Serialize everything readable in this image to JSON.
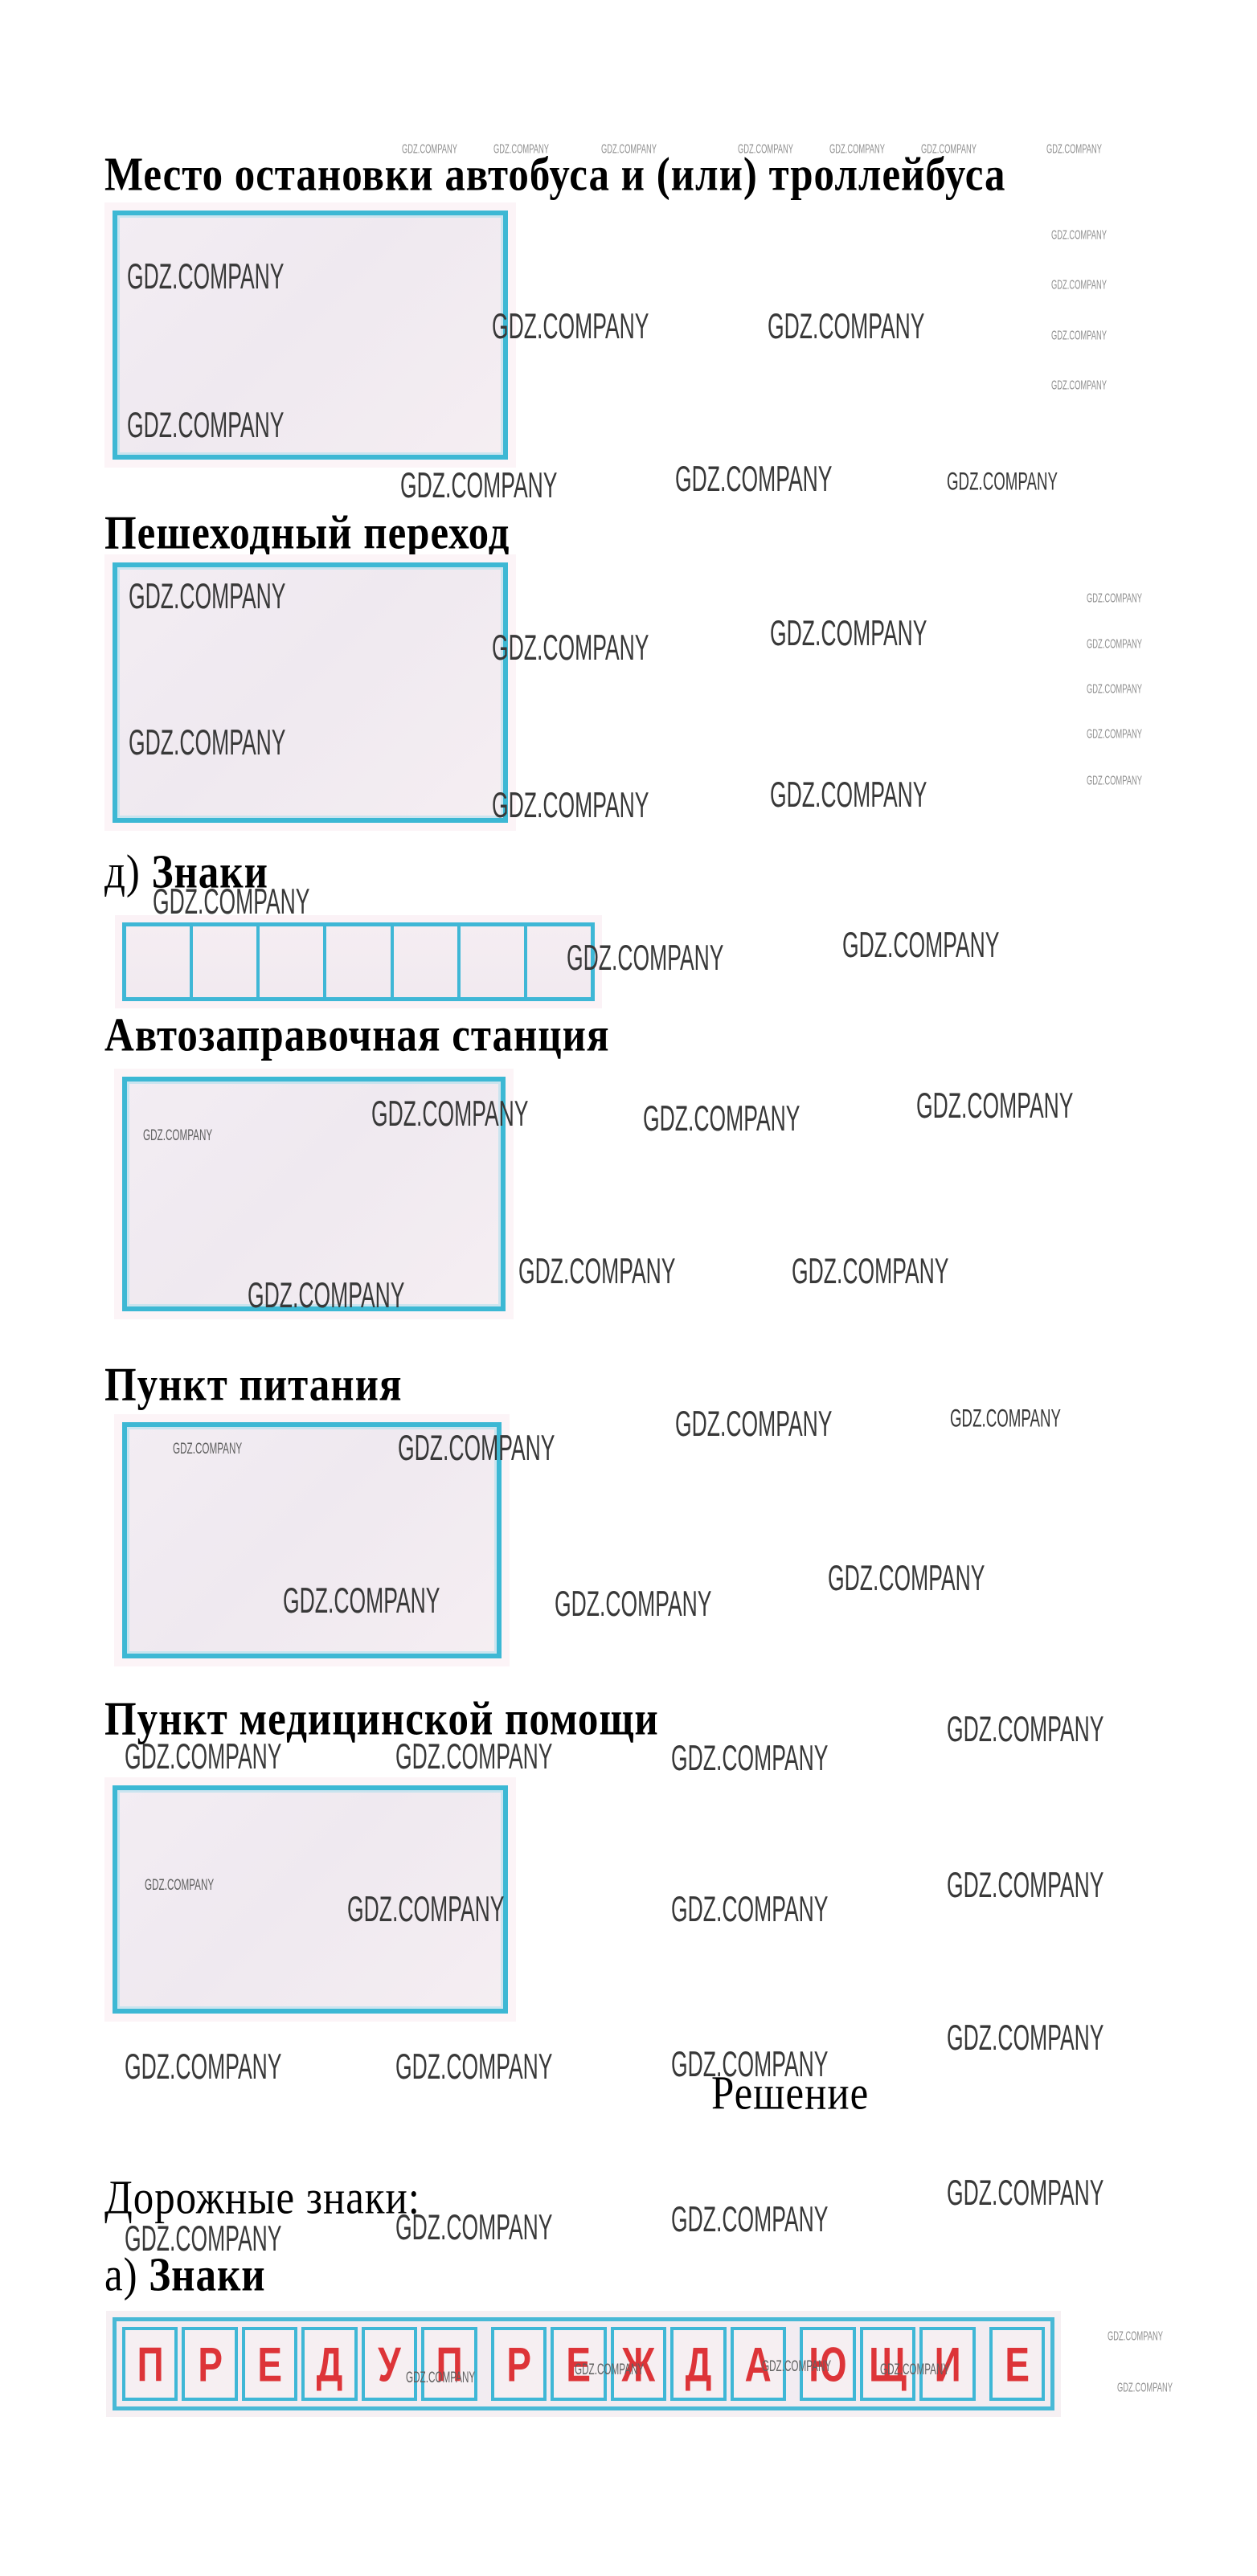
{
  "page": {
    "watermark": "GDZ.COMPANY",
    "colors": {
      "cyan_border": "#3db8d4",
      "red_letter": "#dd3438",
      "box_fill": "#f2ecf2",
      "pink_halo": "#fbf2f6"
    }
  },
  "content": {
    "heading_bus_stop": "Место остановки автобуса и (или) троллейбуса",
    "heading_crosswalk": "Пешеходный переход",
    "item_d_prefix": "д) ",
    "item_d_bold": "Знаки",
    "heading_gas_station": "Автозаправочная станция",
    "heading_food_point": "Пункт питания",
    "heading_medical_aid": "Пункт медицинской помощи",
    "solution_title": "Решение",
    "road_signs_intro": "Дорожные знаки:",
    "item_a_prefix": "а) ",
    "item_a_bold": "Знаки",
    "warning_word": "ПРЕДУПРЕЖДАЮЩИЕ",
    "warning_letters": [
      "П",
      "Р",
      "Е",
      "Д",
      "У",
      "П",
      "Р",
      "Е",
      "Ж",
      "Д",
      "А",
      "Ю",
      "Щ",
      "И",
      "Е"
    ]
  }
}
